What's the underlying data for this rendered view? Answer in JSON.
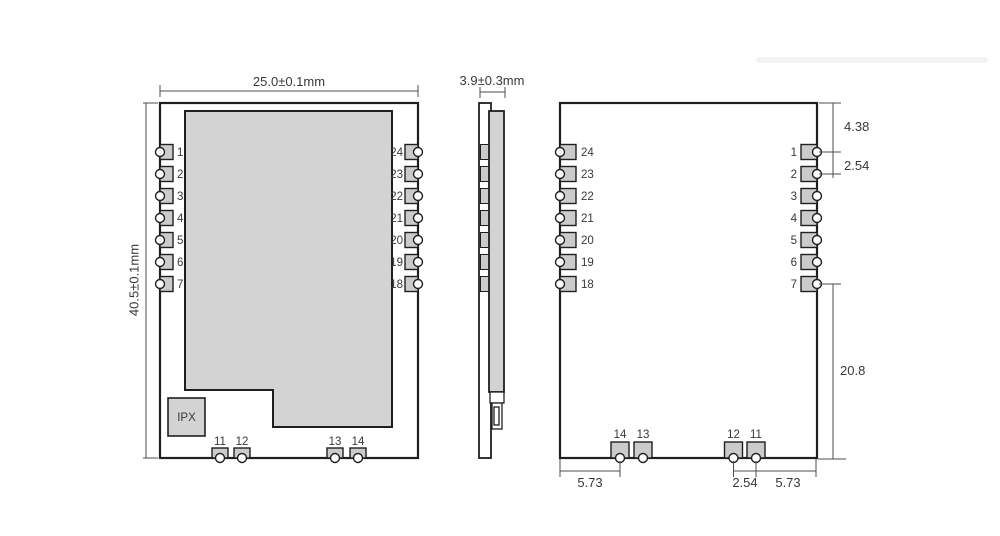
{
  "front_view": {
    "width_dim_label": "25.0±0.1mm",
    "height_dim_label": "40.5±0.1mm",
    "ipx_label": "IPX",
    "left_pins": [
      "1",
      "2",
      "3",
      "4",
      "5",
      "6",
      "7"
    ],
    "right_pins": [
      "24",
      "23",
      "22",
      "21",
      "20",
      "19",
      "18"
    ],
    "bottom_pins": [
      "11",
      "12",
      "13",
      "14"
    ]
  },
  "side_view": {
    "thickness_dim_label": "3.9±0.3mm"
  },
  "back_view": {
    "left_pins": [
      "24",
      "23",
      "22",
      "21",
      "20",
      "19",
      "18"
    ],
    "right_pins": [
      "1",
      "2",
      "3",
      "4",
      "5",
      "6",
      "7"
    ],
    "bottom_pins": [
      "14",
      "13",
      "12",
      "11"
    ],
    "top_edge_to_pin1_dim": "4.38",
    "side_pin_pitch_dim": "2.54",
    "pin7_to_bottom_dim": "20.8",
    "bottom_left_margin_dim": "5.73",
    "bottom_pin_pitch_dim": "2.54",
    "bottom_right_margin_dim": "5.73"
  },
  "colors": {
    "outline": "#1f1f1f",
    "shield_fill": "#d3d3d3",
    "pad_fill": "#cbcbcb",
    "dim_line": "#4d4d4d",
    "text": "#383838"
  }
}
